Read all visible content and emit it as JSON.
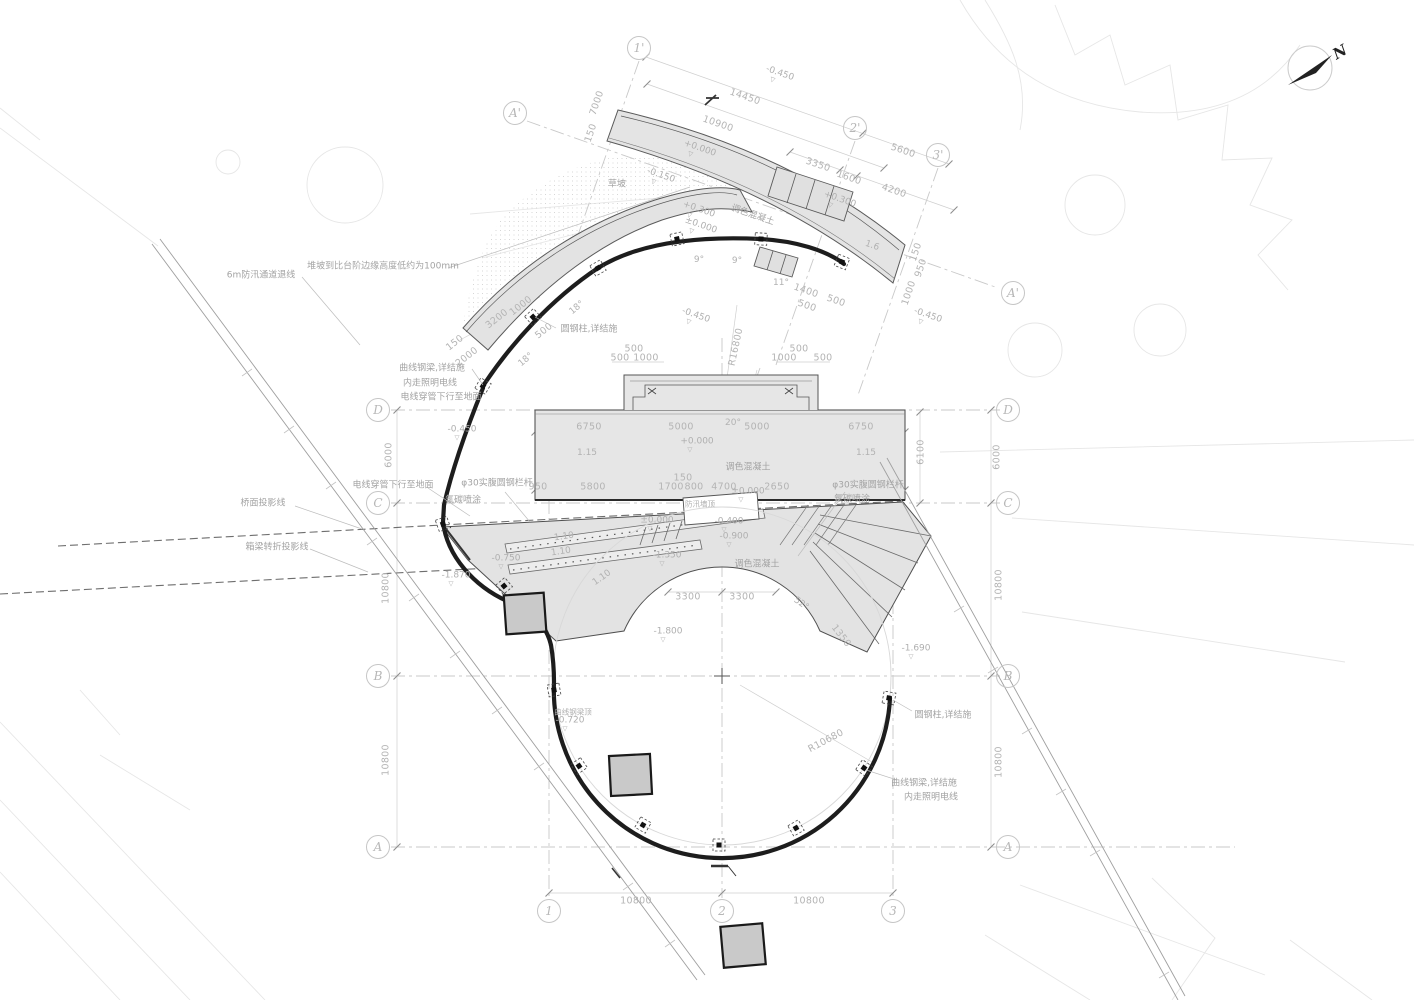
{
  "drawing": {
    "type": "architectural-site-plan",
    "north_label": "N",
    "accent_colors": {
      "paper": "#ffffff",
      "fill_gray": "#e3e3e3",
      "beam_black": "#1d1d1d",
      "dim_gray": "#b4b4b4"
    }
  },
  "grid": {
    "bubbles": [
      {
        "l": "1'",
        "x": 639,
        "y": 48
      },
      {
        "l": "2'",
        "x": 855,
        "y": 128
      },
      {
        "l": "3'",
        "x": 938,
        "y": 155
      },
      {
        "l": "A'",
        "x": 515,
        "y": 113
      },
      {
        "l": "A'",
        "x": 1013,
        "y": 293
      },
      {
        "l": "D",
        "x": 378,
        "y": 410
      },
      {
        "l": "C",
        "x": 378,
        "y": 503
      },
      {
        "l": "B",
        "x": 378,
        "y": 676
      },
      {
        "l": "A",
        "x": 378,
        "y": 847
      },
      {
        "l": "D",
        "x": 1008,
        "y": 410
      },
      {
        "l": "C",
        "x": 1008,
        "y": 503
      },
      {
        "l": "B",
        "x": 1008,
        "y": 676
      },
      {
        "l": "A",
        "x": 1008,
        "y": 847
      },
      {
        "l": "1",
        "x": 549,
        "y": 911
      },
      {
        "l": "2",
        "x": 722,
        "y": 911
      },
      {
        "l": "3",
        "x": 893,
        "y": 911
      }
    ]
  },
  "annotations": [
    {
      "t": "N",
      "x": 1340,
      "y": 52,
      "r": -30,
      "c": "north"
    },
    {
      "t": "14450",
      "x": 745,
      "y": 97,
      "r": 19,
      "c": "dim"
    },
    {
      "t": "10900",
      "x": 718,
      "y": 124,
      "r": 19,
      "c": "dim"
    },
    {
      "t": "5600",
      "x": 903,
      "y": 151,
      "r": 19,
      "c": "dim"
    },
    {
      "t": "3350",
      "x": 818,
      "y": 165,
      "r": 19,
      "c": "dim"
    },
    {
      "t": "1600",
      "x": 849,
      "y": 178,
      "r": 19,
      "c": "dim"
    },
    {
      "t": "4200",
      "x": 894,
      "y": 191,
      "r": 19,
      "c": "dim"
    },
    {
      "t": "1400",
      "x": 806,
      "y": 291,
      "r": 19,
      "c": "dim"
    },
    {
      "t": "500",
      "x": 807,
      "y": 306,
      "r": 19,
      "c": "dim"
    },
    {
      "t": "500",
      "x": 836,
      "y": 301,
      "r": 19,
      "c": "dim"
    },
    {
      "t": "1.6",
      "x": 872,
      "y": 246,
      "r": 19,
      "c": "ang"
    },
    {
      "t": "-0.450",
      "x": 779,
      "y": 76,
      "r": 19,
      "c": "elev"
    },
    {
      "t": "+0.000",
      "x": 699,
      "y": 151,
      "r": 19,
      "c": "elev"
    },
    {
      "t": "-0.150",
      "x": 660,
      "y": 178,
      "r": 19,
      "c": "elev"
    },
    {
      "t": "+0.300",
      "x": 698,
      "y": 212,
      "r": 19,
      "c": "elev"
    },
    {
      "t": "±0.000",
      "x": 700,
      "y": 228,
      "r": 19,
      "c": "elev"
    },
    {
      "t": "+0.300",
      "x": 839,
      "y": 202,
      "r": 19,
      "c": "elev"
    },
    {
      "t": "-0.450",
      "x": 695,
      "y": 318,
      "r": 19,
      "c": "elev"
    },
    {
      "t": "-0.450",
      "x": 927,
      "y": 318,
      "r": 19,
      "c": "elev"
    },
    {
      "t": "调色混凝土",
      "x": 753,
      "y": 214,
      "r": 19,
      "c": "lab"
    },
    {
      "t": "7000",
      "x": 597,
      "y": 103,
      "r": -71,
      "c": "dim"
    },
    {
      "t": "150",
      "x": 591,
      "y": 133,
      "r": -71,
      "c": "dim"
    },
    {
      "t": "150",
      "x": 916,
      "y": 252,
      "r": -71,
      "c": "dim"
    },
    {
      "t": "950",
      "x": 921,
      "y": 268,
      "r": -71,
      "c": "dim"
    },
    {
      "t": "1000",
      "x": 909,
      "y": 293,
      "r": -71,
      "c": "dim"
    },
    {
      "t": "3200",
      "x": 497,
      "y": 319,
      "r": -38,
      "c": "dim"
    },
    {
      "t": "1000",
      "x": 521,
      "y": 306,
      "r": -38,
      "c": "dim"
    },
    {
      "t": "150",
      "x": 455,
      "y": 343,
      "r": -38,
      "c": "dim"
    },
    {
      "t": "2000",
      "x": 467,
      "y": 357,
      "r": -38,
      "c": "dim"
    },
    {
      "t": "500",
      "x": 544,
      "y": 331,
      "r": -38,
      "c": "dim"
    },
    {
      "t": "R16800",
      "x": 736,
      "y": 347,
      "r": -78,
      "c": "dim"
    },
    {
      "t": "R10680",
      "x": 826,
      "y": 741,
      "r": -28,
      "c": "dim"
    },
    {
      "t": "6000",
      "x": 389,
      "y": 455,
      "r": -90,
      "c": "dim"
    },
    {
      "t": "6000",
      "x": 997,
      "y": 457,
      "r": -90,
      "c": "dim"
    },
    {
      "t": "6100",
      "x": 921,
      "y": 452,
      "r": -90,
      "c": "dim"
    },
    {
      "t": "10800",
      "x": 386,
      "y": 588,
      "r": -90,
      "c": "dim"
    },
    {
      "t": "10800",
      "x": 386,
      "y": 760,
      "r": -90,
      "c": "dim"
    },
    {
      "t": "10800",
      "x": 999,
      "y": 585,
      "r": -90,
      "c": "dim"
    },
    {
      "t": "10800",
      "x": 999,
      "y": 762,
      "r": -90,
      "c": "dim"
    },
    {
      "t": "20°",
      "x": 733,
      "y": 423,
      "r": 0,
      "c": "ang"
    },
    {
      "t": "9°",
      "x": 699,
      "y": 260,
      "r": 0,
      "c": "ang"
    },
    {
      "t": "9°",
      "x": 737,
      "y": 261,
      "r": 0,
      "c": "ang"
    },
    {
      "t": "11°",
      "x": 781,
      "y": 283,
      "r": 0,
      "c": "ang"
    },
    {
      "t": "18°",
      "x": 577,
      "y": 308,
      "r": -40,
      "c": "ang"
    },
    {
      "t": "18°",
      "x": 526,
      "y": 360,
      "r": -40,
      "c": "ang"
    },
    {
      "t": "52°",
      "x": 801,
      "y": 604,
      "r": 35,
      "c": "ang"
    },
    {
      "t": "1350",
      "x": 841,
      "y": 636,
      "r": 52,
      "c": "dim"
    },
    {
      "t": "1.10",
      "x": 564,
      "y": 537,
      "r": -8,
      "c": "ang"
    },
    {
      "t": "1.10",
      "x": 561,
      "y": 552,
      "r": -8,
      "c": "ang"
    },
    {
      "t": "1.10",
      "x": 602,
      "y": 578,
      "r": -35,
      "c": "ang"
    },
    {
      "t": "500",
      "x": 634,
      "y": 349,
      "r": 0,
      "c": "dim"
    },
    {
      "t": "500",
      "x": 620,
      "y": 358,
      "r": 0,
      "c": "dim"
    },
    {
      "t": "1000",
      "x": 646,
      "y": 358,
      "r": 0,
      "c": "dim"
    },
    {
      "t": "500",
      "x": 799,
      "y": 349,
      "r": 0,
      "c": "dim"
    },
    {
      "t": "1000",
      "x": 784,
      "y": 358,
      "r": 0,
      "c": "dim"
    },
    {
      "t": "500",
      "x": 823,
      "y": 358,
      "r": 0,
      "c": "dim"
    },
    {
      "t": "6750",
      "x": 589,
      "y": 427,
      "r": 0,
      "c": "dim"
    },
    {
      "t": "5000",
      "x": 681,
      "y": 427,
      "r": 0,
      "c": "dim"
    },
    {
      "t": "5000",
      "x": 757,
      "y": 427,
      "r": 0,
      "c": "dim"
    },
    {
      "t": "6750",
      "x": 861,
      "y": 427,
      "r": 0,
      "c": "dim"
    },
    {
      "t": "1.15",
      "x": 587,
      "y": 453,
      "r": 0,
      "c": "ang"
    },
    {
      "t": "1.15",
      "x": 866,
      "y": 453,
      "r": 0,
      "c": "ang"
    },
    {
      "t": "150",
      "x": 683,
      "y": 478,
      "r": 0,
      "c": "dim"
    },
    {
      "t": "950",
      "x": 538,
      "y": 487,
      "r": 0,
      "c": "dim"
    },
    {
      "t": "5800",
      "x": 593,
      "y": 487,
      "r": 0,
      "c": "dim"
    },
    {
      "t": "1700",
      "x": 671,
      "y": 487,
      "r": 0,
      "c": "dim"
    },
    {
      "t": "800",
      "x": 694,
      "y": 487,
      "r": 0,
      "c": "dim"
    },
    {
      "t": "4700",
      "x": 724,
      "y": 487,
      "r": 0,
      "c": "dim"
    },
    {
      "t": "2650",
      "x": 777,
      "y": 487,
      "r": 0,
      "c": "dim"
    },
    {
      "t": "3300",
      "x": 688,
      "y": 597,
      "r": 0,
      "c": "dim"
    },
    {
      "t": "3300",
      "x": 742,
      "y": 597,
      "r": 0,
      "c": "dim"
    },
    {
      "t": "10800",
      "x": 636,
      "y": 901,
      "r": 0,
      "c": "dim"
    },
    {
      "t": "10800",
      "x": 809,
      "y": 901,
      "r": 0,
      "c": "dim"
    },
    {
      "t": "-0.450",
      "x": 462,
      "y": 432,
      "r": 0,
      "c": "elev"
    },
    {
      "t": "+0.000",
      "x": 697,
      "y": 444,
      "r": 0,
      "c": "elev"
    },
    {
      "t": "±0.000",
      "x": 748,
      "y": 494,
      "r": 0,
      "c": "elev"
    },
    {
      "t": "±0.000",
      "x": 657,
      "y": 523,
      "r": 0,
      "c": "elev"
    },
    {
      "t": "-0.400",
      "x": 729,
      "y": 524,
      "r": 0,
      "c": "elev"
    },
    {
      "t": "-0.900",
      "x": 734,
      "y": 539,
      "r": 0,
      "c": "elev"
    },
    {
      "t": "-1.350",
      "x": 667,
      "y": 558,
      "r": 0,
      "c": "elev"
    },
    {
      "t": "-0.750",
      "x": 506,
      "y": 561,
      "r": 0,
      "c": "elev"
    },
    {
      "t": "-1.870",
      "x": 456,
      "y": 578,
      "r": 0,
      "c": "elev"
    },
    {
      "t": "-1.800",
      "x": 668,
      "y": 634,
      "r": 0,
      "c": "elev"
    },
    {
      "t": "-1.690",
      "x": 916,
      "y": 651,
      "r": 0,
      "c": "elev"
    },
    {
      "t": "-0.720",
      "x": 570,
      "y": 723,
      "r": 0,
      "c": "elev"
    },
    {
      "t": "6m防汛通道退线",
      "x": 261,
      "y": 274,
      "r": 0,
      "c": "lab"
    },
    {
      "t": "堆坡到比台阶边缘高度低约为100mm",
      "x": 383,
      "y": 265,
      "r": 0,
      "c": "lab"
    },
    {
      "t": "草坡",
      "x": 617,
      "y": 183,
      "r": 0,
      "c": "lab"
    },
    {
      "t": "曲线钢梁,详结施",
      "x": 432,
      "y": 367,
      "r": 0,
      "c": "lab"
    },
    {
      "t": "内走照明电线",
      "x": 430,
      "y": 382,
      "r": 0,
      "c": "lab"
    },
    {
      "t": "电线穿管下行至地面",
      "x": 441,
      "y": 396,
      "r": 0,
      "c": "lab"
    },
    {
      "t": "圆钢柱,详结施",
      "x": 589,
      "y": 328,
      "r": 0,
      "c": "lab"
    },
    {
      "t": "电线穿管下行至地面",
      "x": 393,
      "y": 484,
      "r": 0,
      "c": "lab"
    },
    {
      "t": "φ30实腹圆钢栏杆",
      "x": 497,
      "y": 482,
      "r": 0,
      "c": "lab"
    },
    {
      "t": "氟碳喷涂",
      "x": 463,
      "y": 499,
      "r": 0,
      "c": "lab"
    },
    {
      "t": "φ30实腹圆钢栏杆",
      "x": 868,
      "y": 484,
      "r": 0,
      "c": "lab"
    },
    {
      "t": "氟碳喷涂",
      "x": 852,
      "y": 498,
      "r": 0,
      "c": "lab"
    },
    {
      "t": "调色混凝土",
      "x": 748,
      "y": 466,
      "r": 0,
      "c": "lab"
    },
    {
      "t": "调色混凝土",
      "x": 757,
      "y": 563,
      "r": 0,
      "c": "lab"
    },
    {
      "t": "防汛墙顶",
      "x": 700,
      "y": 504,
      "r": 0,
      "c": "sm"
    },
    {
      "t": "桥面投影线",
      "x": 263,
      "y": 502,
      "r": 0,
      "c": "lab"
    },
    {
      "t": "箱梁转折投影线",
      "x": 277,
      "y": 546,
      "r": 0,
      "c": "lab"
    },
    {
      "t": "曲线钢梁顶",
      "x": 573,
      "y": 712,
      "r": 0,
      "c": "sm"
    },
    {
      "t": "圆钢柱,详结施",
      "x": 943,
      "y": 714,
      "r": 0,
      "c": "lab"
    },
    {
      "t": "曲线钢梁,详结施",
      "x": 924,
      "y": 782,
      "r": 0,
      "c": "lab"
    },
    {
      "t": "内走照明电线",
      "x": 931,
      "y": 796,
      "r": 0,
      "c": "lab"
    }
  ]
}
